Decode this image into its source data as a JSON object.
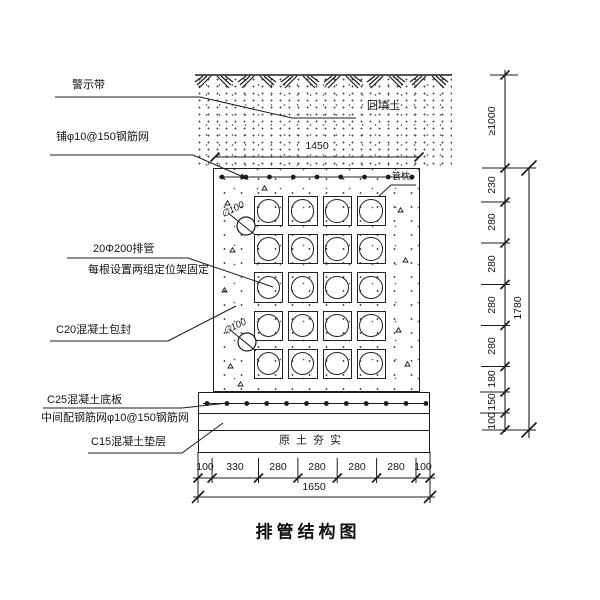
{
  "title": "排管结构图",
  "callouts": {
    "warning_tape": "警示带",
    "top_mesh": "铺φ10@150钢筋网",
    "backfill": "回填土",
    "pipes_line1": "20Φ200排管",
    "pipes_line2": "每根设置两组定位架固定",
    "encasement": "C20混凝土包封",
    "pipe_pillow": "管枕",
    "base_slab": "C25混凝土底板",
    "mid_mesh": "中间配钢筋网φ10@150钢筋网",
    "cushion": "C15混凝土垫层",
    "compacted_soil": "原土夯实",
    "pipe_dia_top": "∅100",
    "pipe_dia_bottom": "∅100"
  },
  "dimensions": {
    "top_width": "1450",
    "bottom_segments": [
      "100",
      "330",
      "280",
      "280",
      "280",
      "280",
      "100"
    ],
    "bottom_total": "1650",
    "cover_depth": "≥1000",
    "right_segments": [
      "230",
      "280",
      "280",
      "280",
      "280",
      "180",
      "150",
      "100"
    ],
    "right_total": "1780"
  },
  "structure": {
    "pipe_rows": 5,
    "pipe_cols": 4
  },
  "colors": {
    "line": "#1c1c1c",
    "paper": "#ffffff"
  }
}
